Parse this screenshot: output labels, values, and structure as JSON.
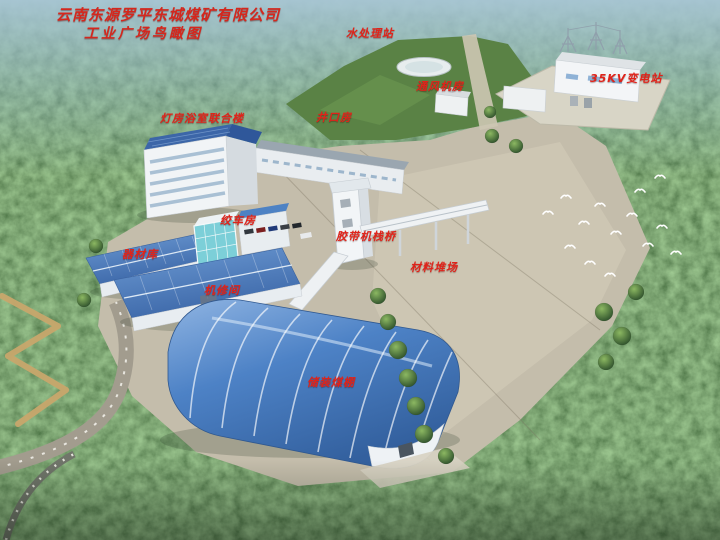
{
  "title": {
    "line1": "云南东源罗平东城煤矿有限公司",
    "line2": "工业广场鸟瞰图"
  },
  "labels": [
    {
      "id": "water-treatment-station",
      "text": "水处理站"
    },
    {
      "id": "ventilation-fan-house",
      "text": "通风机房"
    },
    {
      "id": "substation-35kv",
      "text": "35KV变电站"
    },
    {
      "id": "lamp-bath-combined-building",
      "text": "灯房浴室联合楼"
    },
    {
      "id": "shaft-mouth-house",
      "text": "井口房"
    },
    {
      "id": "winch-house",
      "text": "绞车房"
    },
    {
      "id": "equipment-warehouse",
      "text": "器材库"
    },
    {
      "id": "belt-conveyor-trestle",
      "text": "胶带机栈桥"
    },
    {
      "id": "material-yard",
      "text": "材料堆场"
    },
    {
      "id": "machine-repair-shop",
      "text": "机修间"
    },
    {
      "id": "coal-storage-shed",
      "text": "储装煤棚"
    }
  ],
  "colors": {
    "label_red": "#e0231a",
    "roof_blue": "#4d82c4",
    "glass_teal": "#7ccfd8",
    "pavement_tan": "#c4bdab",
    "forest_green": "#33502f",
    "haze_blue": "#9fc0cf",
    "pond_white": "#e7edee"
  }
}
